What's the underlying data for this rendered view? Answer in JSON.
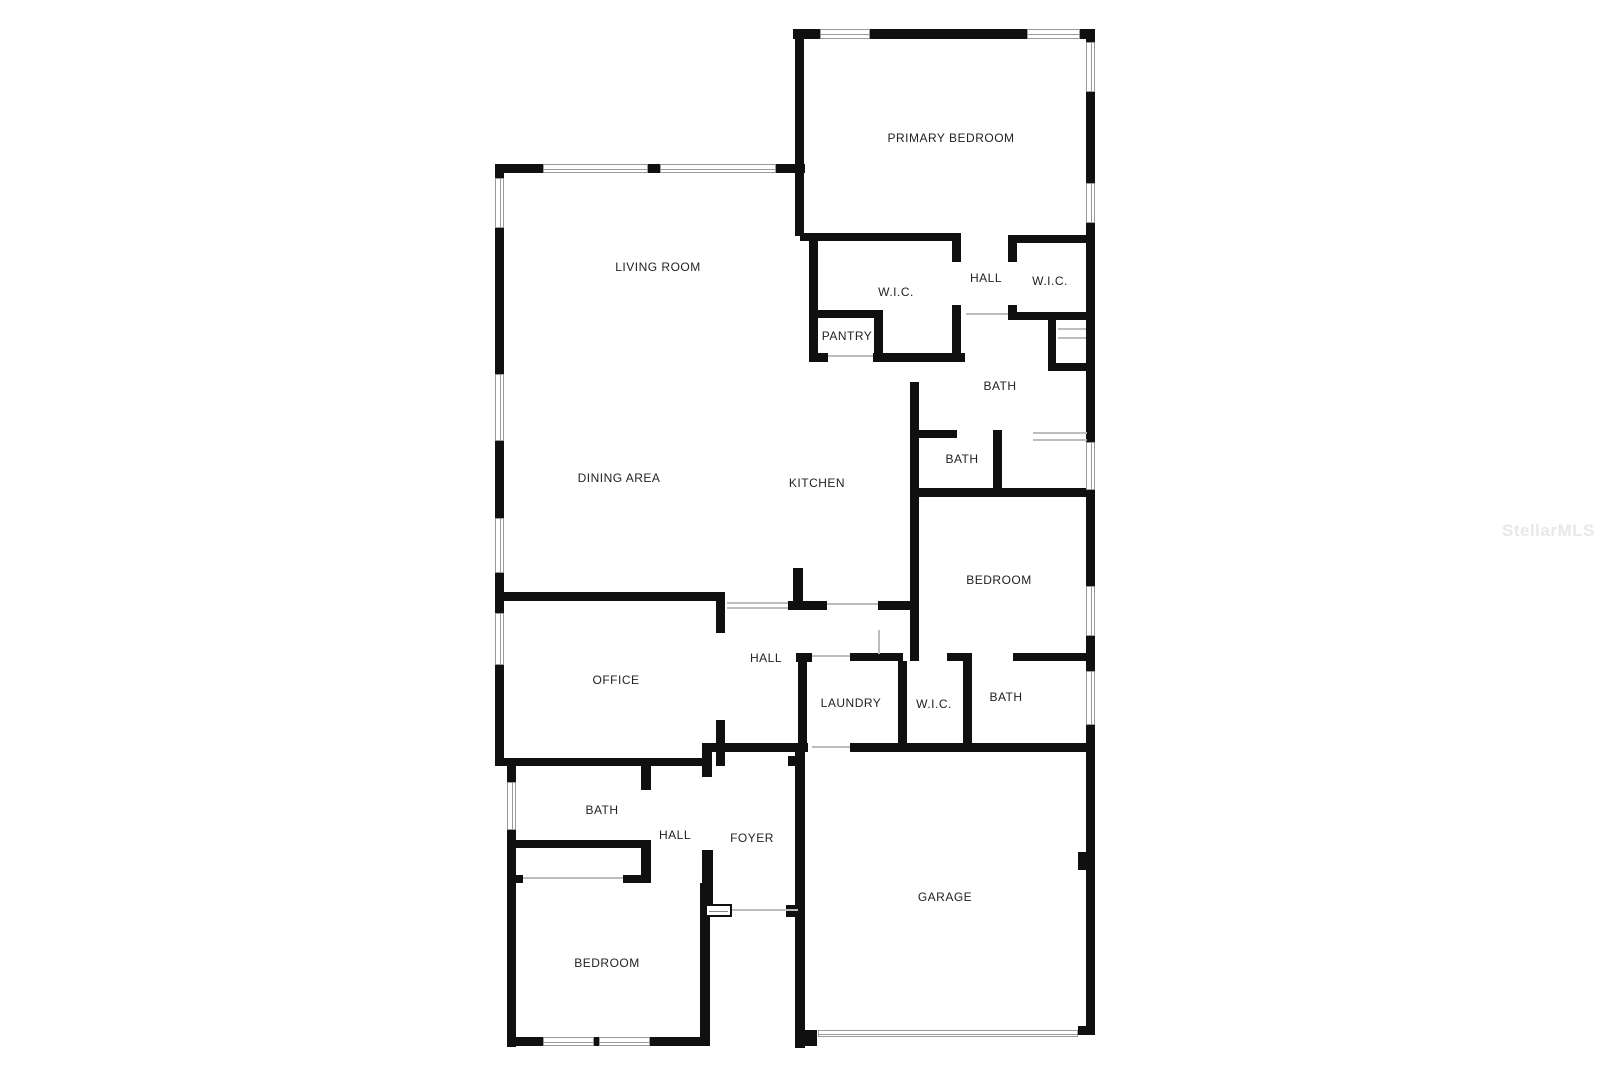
{
  "watermark": "StellarMLS",
  "plan": {
    "wall_color": "#101010",
    "window_line_color": "#9a9a9a",
    "opening_line_color": "#bdbdbd",
    "label_color": "#222222",
    "rooms": [
      {
        "label": "PRIMARY BEDROOM",
        "x": 951,
        "y": 138
      },
      {
        "label": "LIVING ROOM",
        "x": 658,
        "y": 267
      },
      {
        "label": "W.I.C.",
        "x": 896,
        "y": 292
      },
      {
        "label": "HALL",
        "x": 986,
        "y": 278
      },
      {
        "label": "W.I.C.",
        "x": 1050,
        "y": 281
      },
      {
        "label": "PANTRY",
        "x": 847,
        "y": 336
      },
      {
        "label": "BATH",
        "x": 1000,
        "y": 386
      },
      {
        "label": "BATH",
        "x": 962,
        "y": 459
      },
      {
        "label": "DINING AREA",
        "x": 619,
        "y": 478
      },
      {
        "label": "KITCHEN",
        "x": 817,
        "y": 483
      },
      {
        "label": "BEDROOM",
        "x": 999,
        "y": 580
      },
      {
        "label": "OFFICE",
        "x": 616,
        "y": 680
      },
      {
        "label": "HALL",
        "x": 766,
        "y": 658
      },
      {
        "label": "LAUNDRY",
        "x": 851,
        "y": 703
      },
      {
        "label": "W.I.C.",
        "x": 934,
        "y": 704
      },
      {
        "label": "BATH",
        "x": 1006,
        "y": 697
      },
      {
        "label": "BATH",
        "x": 602,
        "y": 810
      },
      {
        "label": "HALL",
        "x": 675,
        "y": 835
      },
      {
        "label": "FOYER",
        "x": 752,
        "y": 838
      },
      {
        "label": "BEDROOM",
        "x": 607,
        "y": 963
      },
      {
        "label": "GARAGE",
        "x": 945,
        "y": 897
      }
    ],
    "walls": [
      [
        793,
        29,
        302,
        10
      ],
      [
        1086,
        29,
        9,
        1006
      ],
      [
        795,
        29,
        9,
        207
      ],
      [
        495,
        164,
        310,
        9
      ],
      [
        495,
        164,
        9,
        602
      ],
      [
        507,
        758,
        9,
        289
      ],
      [
        800,
        233,
        160,
        8
      ],
      [
        809,
        233,
        9,
        128
      ],
      [
        952,
        233,
        9,
        128
      ],
      [
        809,
        310,
        74,
        8
      ],
      [
        874,
        310,
        9,
        50
      ],
      [
        809,
        353,
        156,
        9
      ],
      [
        1008,
        235,
        87,
        8
      ],
      [
        1008,
        235,
        9,
        85
      ],
      [
        1008,
        312,
        80,
        8
      ],
      [
        1048,
        320,
        8,
        50
      ],
      [
        1048,
        363,
        38,
        8
      ],
      [
        910,
        382,
        9,
        279
      ],
      [
        918,
        430,
        39,
        8
      ],
      [
        993,
        430,
        9,
        67
      ],
      [
        912,
        488,
        178,
        9
      ],
      [
        495,
        592,
        230,
        9
      ],
      [
        716,
        592,
        9,
        41
      ],
      [
        716,
        720,
        9,
        46
      ],
      [
        788,
        601,
        128,
        9
      ],
      [
        793,
        568,
        10,
        41
      ],
      [
        495,
        758,
        215,
        8
      ],
      [
        641,
        766,
        10,
        24
      ],
      [
        641,
        840,
        10,
        43
      ],
      [
        512,
        840,
        138,
        8
      ],
      [
        508,
        875,
        15,
        8
      ],
      [
        623,
        875,
        28,
        8
      ],
      [
        700,
        883,
        10,
        163
      ],
      [
        507,
        1037,
        203,
        9
      ],
      [
        796,
        653,
        16,
        9
      ],
      [
        850,
        653,
        53,
        8
      ],
      [
        947,
        653,
        25,
        8
      ],
      [
        1013,
        653,
        77,
        8
      ],
      [
        798,
        653,
        9,
        99
      ],
      [
        898,
        661,
        9,
        84
      ],
      [
        963,
        661,
        9,
        84
      ],
      [
        850,
        743,
        240,
        9
      ],
      [
        710,
        743,
        98,
        9
      ],
      [
        702,
        743,
        10,
        34
      ],
      [
        702,
        850,
        11,
        67
      ],
      [
        786,
        905,
        14,
        12
      ],
      [
        795,
        745,
        10,
        303
      ],
      [
        788,
        756,
        8,
        10
      ],
      [
        795,
        1030,
        22,
        16
      ],
      [
        1078,
        1026,
        17,
        9
      ],
      [
        1078,
        852,
        8,
        18
      ]
    ],
    "gaps": [
      [
        952,
        262,
        9,
        43
      ],
      [
        1008,
        262,
        9,
        43
      ],
      [
        828,
        353,
        45,
        9
      ],
      [
        827,
        601,
        51,
        9
      ]
    ],
    "windows": [
      [
        820,
        29,
        50,
        10
      ],
      [
        1027,
        29,
        53,
        10
      ],
      [
        543,
        164,
        105,
        9
      ],
      [
        660,
        164,
        116,
        9
      ],
      [
        495,
        178,
        9,
        50
      ],
      [
        495,
        374,
        9,
        67
      ],
      [
        495,
        518,
        9,
        55
      ],
      [
        495,
        613,
        9,
        52
      ],
      [
        507,
        782,
        9,
        48
      ],
      [
        1086,
        42,
        9,
        50
      ],
      [
        1086,
        183,
        9,
        40
      ],
      [
        1086,
        442,
        9,
        48
      ],
      [
        1086,
        586,
        9,
        50
      ],
      [
        1086,
        671,
        9,
        54
      ],
      [
        543,
        1037,
        51,
        9
      ],
      [
        599,
        1037,
        51,
        9
      ],
      [
        818,
        1030,
        260,
        7
      ]
    ],
    "thin_lines": [
      [
        828,
        355,
        45,
        2
      ],
      [
        966,
        313,
        42,
        2
      ],
      [
        727,
        602,
        61,
        2
      ],
      [
        727,
        607,
        61,
        2
      ],
      [
        878,
        630,
        2,
        24
      ],
      [
        812,
        655,
        38,
        2
      ],
      [
        812,
        746,
        38,
        2
      ],
      [
        523,
        877,
        100,
        2
      ],
      [
        713,
        909,
        85,
        2
      ],
      [
        827,
        603,
        51,
        2
      ],
      [
        1058,
        328,
        28,
        2
      ],
      [
        1058,
        337,
        28,
        2
      ],
      [
        1033,
        432,
        54,
        2
      ],
      [
        1033,
        439,
        54,
        2
      ]
    ],
    "door_symbols": [
      [
        705,
        904,
        27,
        13
      ]
    ]
  }
}
